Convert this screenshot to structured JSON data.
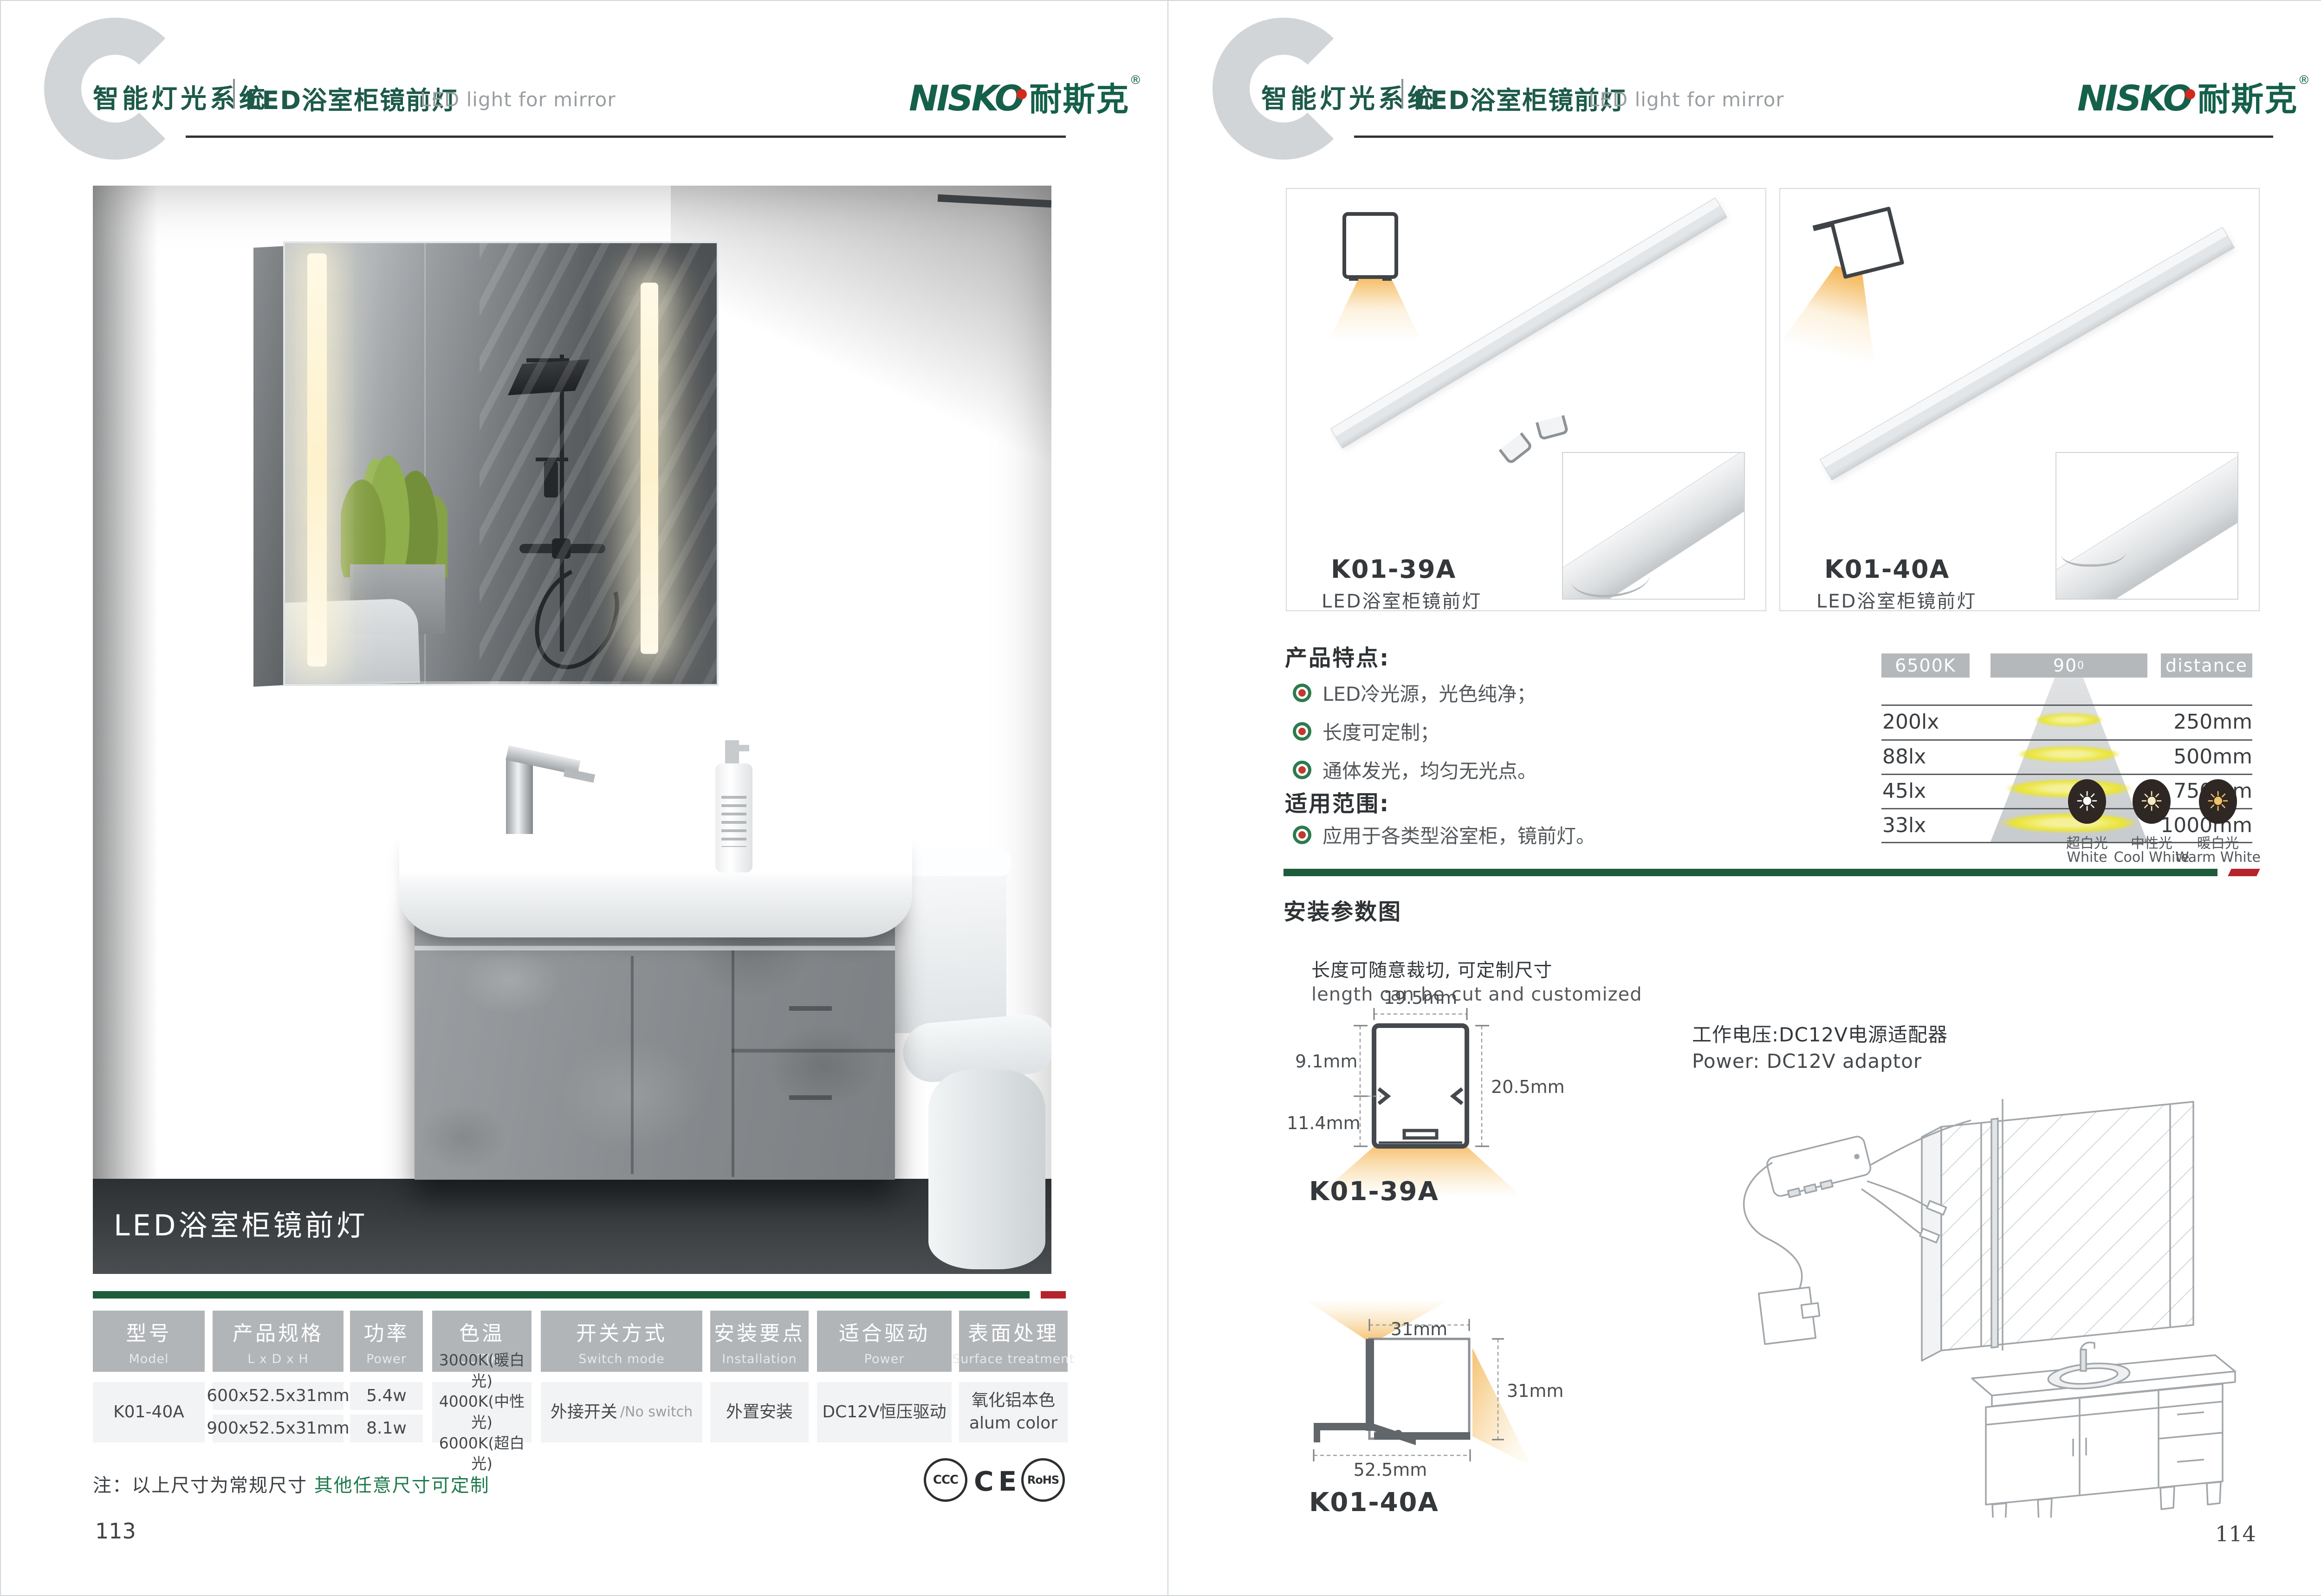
{
  "header": {
    "system": "智能灯光系统",
    "product_zh": "LED浴室柜镜前灯",
    "product_en": "LED light for mirror",
    "brand": "NISKO",
    "brand_cn": "耐斯克",
    "registered": "®"
  },
  "left_page": {
    "photo_caption": "LED浴室柜镜前灯",
    "table": {
      "columns": [
        {
          "zh": "型号",
          "en": "Model"
        },
        {
          "zh": "产品规格",
          "en": "L x D x H"
        },
        {
          "zh": "功率",
          "en": "Power"
        },
        {
          "zh": "色温",
          "en": "CCT(K)"
        },
        {
          "zh": "开关方式",
          "en": "Switch mode"
        },
        {
          "zh": "安装要点",
          "en": "Installation"
        },
        {
          "zh": "适合驱动",
          "en": "Power"
        },
        {
          "zh": "表面处理",
          "en": "Surface treatment"
        }
      ],
      "model": "K01-40A",
      "sizes": [
        "600x52.5x31mm",
        "900x52.5x31mm"
      ],
      "powers": [
        "5.4w",
        "8.1w"
      ],
      "cct": [
        "3000K(暖白光)",
        "4000K(中性光)",
        "6000K(超白光)"
      ],
      "switch_zh": "外接开关",
      "switch_en": "/No switch",
      "installation": "外置安装",
      "driver": "DC12V恒压驱动",
      "surface_zh": "氧化铝本色",
      "surface_en": "alum color"
    },
    "note_label": "注：以上尺寸为常规尺寸 ",
    "note_highlight": "其他任意尺寸可定制",
    "certs": [
      "CCC",
      "CE",
      "RoHS"
    ],
    "page_number": "113"
  },
  "right_page": {
    "products": [
      {
        "model": "K01-39A",
        "name": "LED浴室柜镜前灯"
      },
      {
        "model": "K01-40A",
        "name": "LED浴室柜镜前灯"
      }
    ],
    "features": {
      "title": "产品特点:",
      "items": [
        "LED冷光源，光色纯净；",
        "长度可定制；",
        "通体发光，均匀无光点。"
      ]
    },
    "scope": {
      "title": "适用范围:",
      "items": [
        "应用于各类型浴室柜，镜前灯。"
      ]
    },
    "photometry": {
      "cct": "6500K",
      "angle": "90",
      "angle_sup": "0",
      "distance_label": "distance",
      "rows": [
        {
          "lux": "200lx",
          "distance": "250mm"
        },
        {
          "lux": "88lx",
          "distance": "500mm"
        },
        {
          "lux": "45lx",
          "distance": "750mm"
        },
        {
          "lux": "33lx",
          "distance": "1000mm"
        }
      ]
    },
    "color_options": [
      {
        "zh": "超白光",
        "en": "White"
      },
      {
        "zh": "中性光",
        "en": "Cool White"
      },
      {
        "zh": "暖白光",
        "en": "Warm White"
      }
    ],
    "install": {
      "title": "安装参数图",
      "cut_zh": "长度可随意裁切, 可定制尺寸",
      "cut_en": "length can be cut and customized",
      "power_zh": "工作电压:DC12V电源适配器",
      "power_en": "Power: DC12V adaptor",
      "profile1": {
        "model": "K01-39A",
        "w": "19.5mm",
        "h_top": "9.1mm",
        "h_bottom": "11.4mm",
        "h_total": "20.5mm"
      },
      "profile2": {
        "model": "K01-40A",
        "w": "31mm",
        "h": "31mm",
        "base": "52.5mm"
      }
    },
    "page_number": "114"
  }
}
